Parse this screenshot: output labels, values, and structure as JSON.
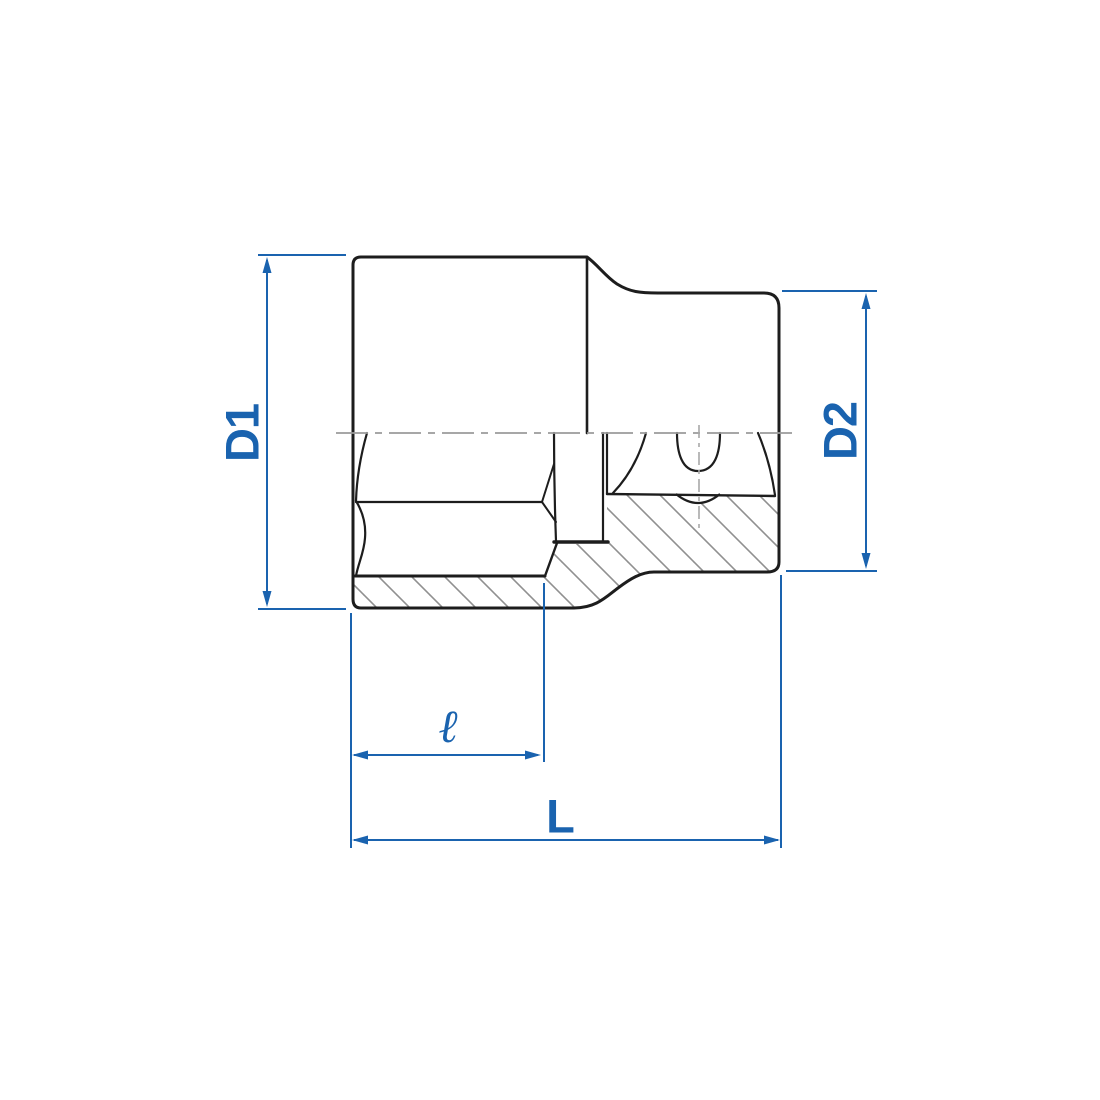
{
  "drawing": {
    "title": "socket cross-section dimension drawing",
    "labels": {
      "d1": "D1",
      "d2": "D2",
      "length_partial": "ℓ",
      "length_total": "L"
    },
    "colors": {
      "dimension": "#1a63af",
      "outline": "#1d1d1d",
      "hatch": "#909090",
      "centerline": "#9b9b9b",
      "axis": "#a8a8a8",
      "background": "#ffffff"
    }
  }
}
